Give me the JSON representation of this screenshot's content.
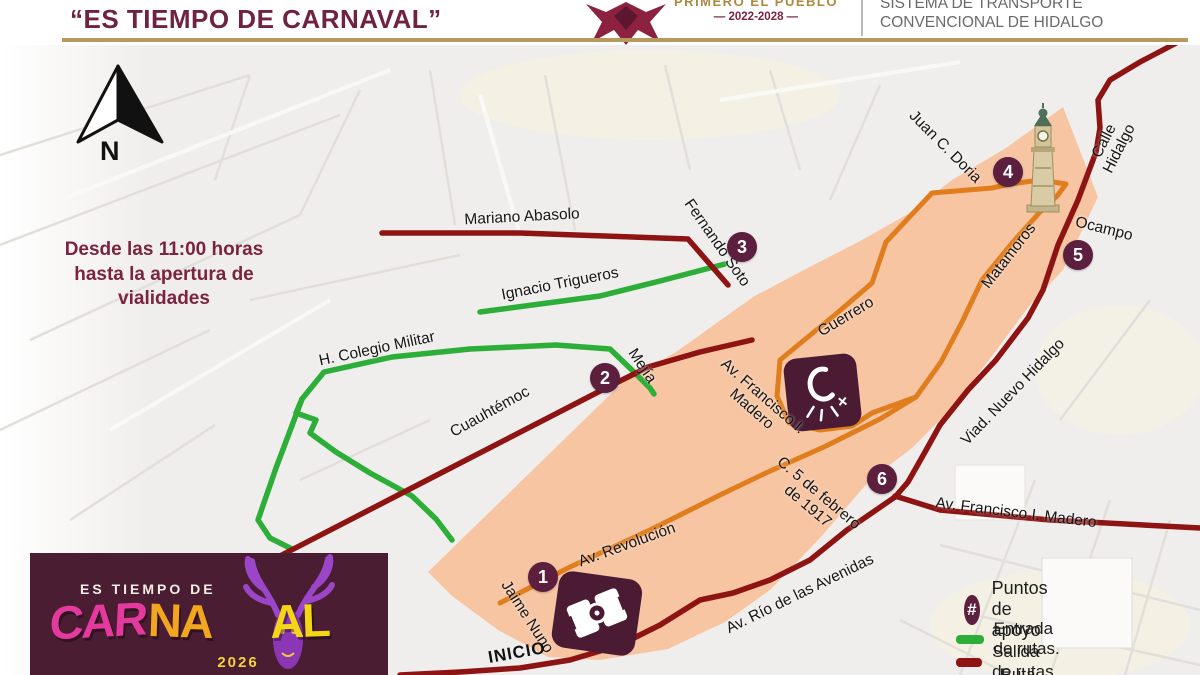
{
  "header": {
    "title": "“ES TIEMPO DE CARNAVAL”",
    "logo": {
      "slogan": "PRIMERO EL PUEBLO",
      "period": "— 2022-2028 —"
    },
    "agency": {
      "line1": "SISTEMA DE TRANSPORTE",
      "line2": "CONVENCIONAL DE HIDALGO"
    }
  },
  "map": {
    "north_label": "N",
    "notice": "Desde las 11:00 horas\nhasta la apertura de\nvialidades",
    "start_label": "INICIO",
    "streets": [
      {
        "label": "Mariano Abasolo"
      },
      {
        "label": "Fernando Soto"
      },
      {
        "label": "Ignacio Trigueros"
      },
      {
        "label": "H. Colegio Militar"
      },
      {
        "label": "Mejía"
      },
      {
        "label": "Cuauhtémoc"
      },
      {
        "label": "Guerrero"
      },
      {
        "label": "Av. Francisco I.\nMadero"
      },
      {
        "label": "C. 5 de febrero\nde 1917"
      },
      {
        "label": "Matamoros"
      },
      {
        "label": "Juan C. Doria"
      },
      {
        "label": "Calle Hidalgo"
      },
      {
        "label": "Ocampo"
      },
      {
        "label": "Viad. Nuevo Hidalgo"
      },
      {
        "label": "Av. Francisco I. Madero"
      },
      {
        "label": "Av. Río de las Avenidas"
      },
      {
        "label": "Av. Revolución"
      },
      {
        "label": "Jaime Nuno"
      }
    ],
    "markers": [
      {
        "n": "1"
      },
      {
        "n": "2"
      },
      {
        "n": "3"
      },
      {
        "n": "4"
      },
      {
        "n": "5"
      },
      {
        "n": "6"
      }
    ]
  },
  "legend": {
    "items": [
      {
        "symbol": "#",
        "label": "Puntos de apoyo"
      },
      {
        "label": "Entrada de rutas."
      },
      {
        "label": "Salida de rutas."
      },
      {
        "label": "Ruta carnaval"
      }
    ]
  },
  "footer_logo": {
    "top_line": "ES TIEMPO DE",
    "word": {
      "part1": "CAR",
      "part2": "NA",
      "part3": "AL"
    },
    "year": "2026"
  },
  "colors": {
    "route_entry_green": "#2cae38",
    "route_exit_red": "#8e1313",
    "route_carnaval_orange": "#e07e1d",
    "zone_peach": "#f7c5a2",
    "marker_maroon": "#5c1f3d",
    "brand_maroon": "#6f2242",
    "gold": "#b59a5b"
  }
}
